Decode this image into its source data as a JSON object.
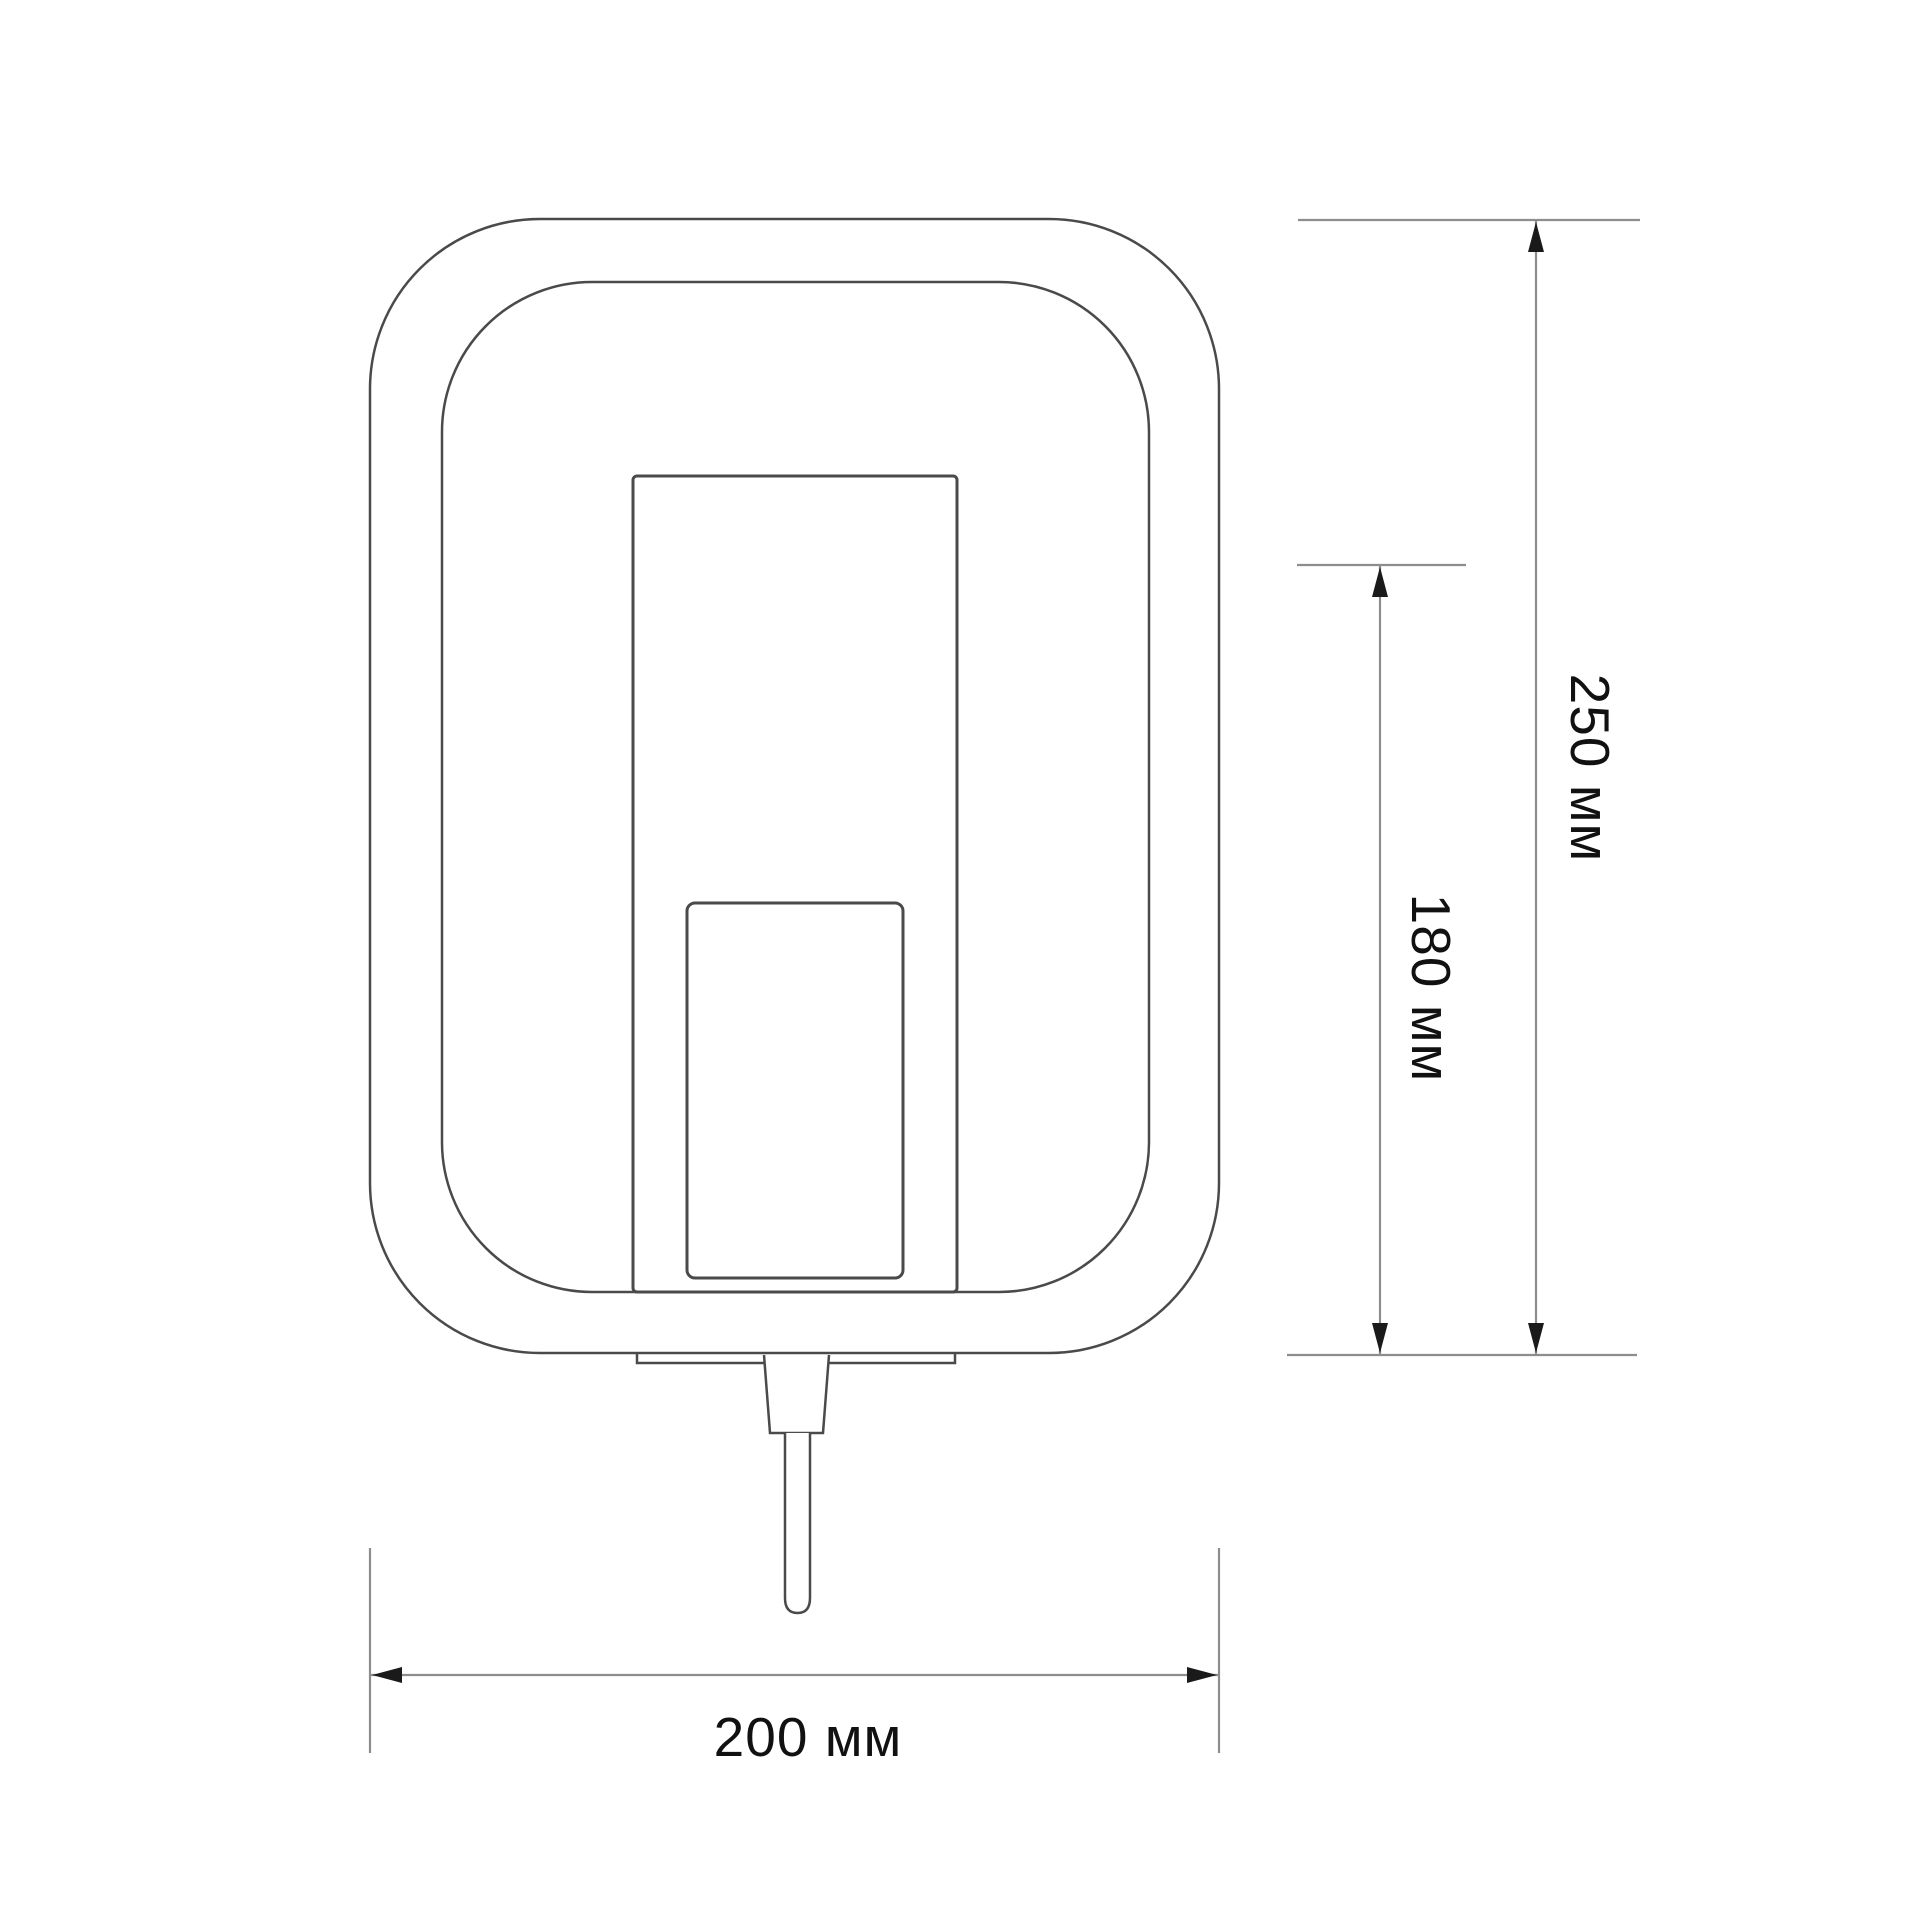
{
  "drawing": {
    "kind": "technical-dimension-drawing",
    "subject": "wall-mounted device front view with plug",
    "units": "мм",
    "dimensions": {
      "height": {
        "value": 250,
        "label": "250 мм"
      },
      "inner_height": {
        "value": 180,
        "label": "180 мм"
      },
      "width": {
        "value": 200,
        "label": "200 мм"
      }
    },
    "colors": {
      "background": "#ffffff",
      "outline": "#4a4a4a",
      "dimension_line": "#8d8d8d",
      "arrow": "#1a1a1a",
      "text": "#111111"
    }
  }
}
